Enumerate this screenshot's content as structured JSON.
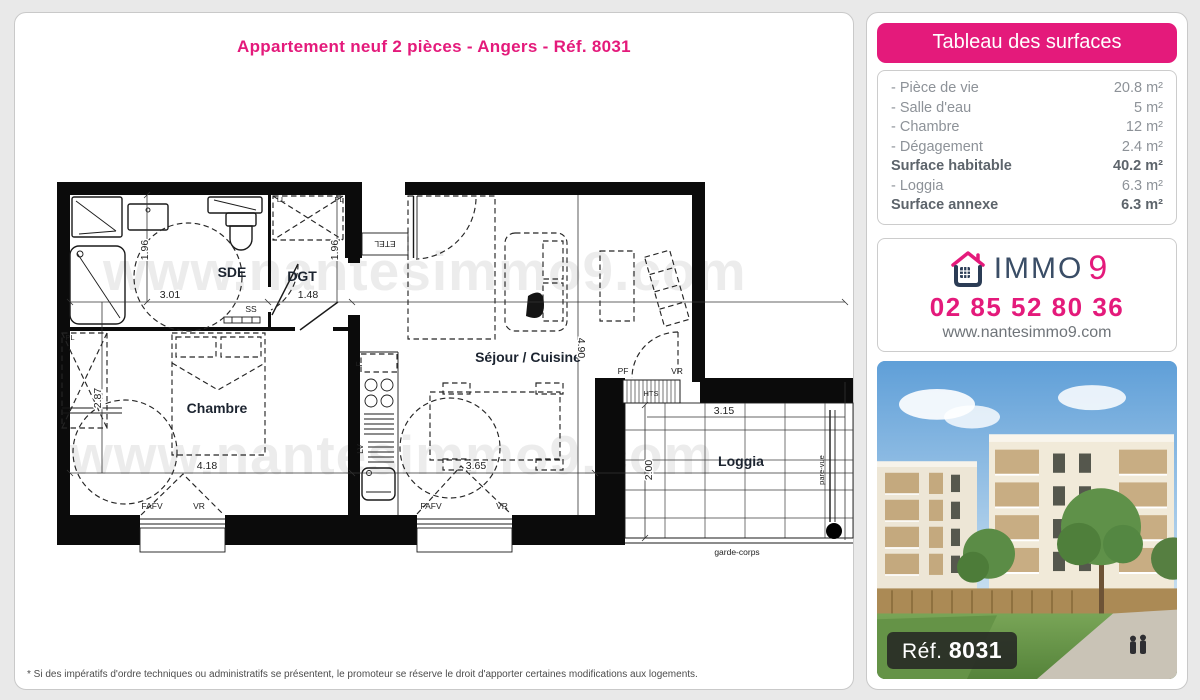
{
  "page": {
    "title": "Appartement neuf 2 pièces - Angers - Réf. 8031",
    "footnote": "* Si des impératifs d'ordre techniques ou administratifs se présentent, le promoteur se réserve le droit d'apporter certaines modifications aux logements."
  },
  "watermark": "www.nantesimmo9.com",
  "surfaces": {
    "header": "Tableau des surfaces",
    "rows": [
      {
        "label": "- Pièce de vie",
        "value": "20.8 m²"
      },
      {
        "label": "- Salle d'eau",
        "value": "5 m²"
      },
      {
        "label": "- Chambre",
        "value": "12 m²"
      },
      {
        "label": "- Dégagement",
        "value": "2.4 m²"
      },
      {
        "label": "Surface habitable",
        "value": "40.2 m²"
      },
      {
        "label": "- Loggia",
        "value": "6.3 m²"
      },
      {
        "label": "Surface annexe",
        "value": "6.3 m²"
      }
    ]
  },
  "agency": {
    "brand_immo": "IMMO",
    "brand_9": "9",
    "phone": "02 85 52 80 36",
    "website": "www.nantesimmo9.com"
  },
  "photo": {
    "ref_label": "Réf.",
    "ref_number": "8031"
  },
  "plan": {
    "rooms": [
      {
        "t": "SDE"
      },
      {
        "t": "DGT"
      },
      {
        "t": "Chambre"
      },
      {
        "t": "Séjour / Cuisine"
      },
      {
        "t": "Loggia"
      }
    ],
    "notes": [
      {
        "t": "ETEL"
      },
      {
        "t": "SS"
      },
      {
        "t": "LL"
      },
      {
        "t": "PL"
      },
      {
        "t": "PL"
      },
      {
        "t": "F"
      },
      {
        "t": "LV"
      },
      {
        "t": "FAFV"
      },
      {
        "t": "VR"
      },
      {
        "t": "FAFV"
      },
      {
        "t": "VR"
      },
      {
        "t": "PF"
      },
      {
        "t": "VR"
      },
      {
        "t": "HTS"
      },
      {
        "t": "garde-corps"
      },
      {
        "t": "pare-vue"
      }
    ],
    "dims": [
      {
        "v": "1.96"
      },
      {
        "v": "3.01"
      },
      {
        "v": "1.48"
      },
      {
        "v": "1.96"
      },
      {
        "v": "2.87"
      },
      {
        "v": "4.18"
      },
      {
        "v": "3.65"
      },
      {
        "v": "4.90"
      },
      {
        "v": "3.15"
      },
      {
        "v": "2.00"
      }
    ]
  },
  "colors": {
    "pink": "#e41a7b",
    "navy": "#3a4d66"
  }
}
